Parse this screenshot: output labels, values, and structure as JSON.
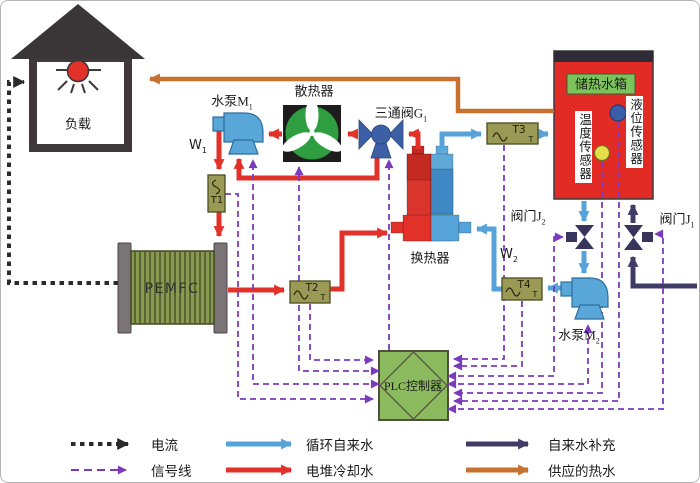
{
  "labels": {
    "load": "负载",
    "pump_m1": {
      "text": "水泵M",
      "sub": "1"
    },
    "radiator": "散热器",
    "valve_g1": {
      "text": "三通阀G",
      "sub": "1"
    },
    "w1": {
      "text": "W",
      "sub": "1"
    },
    "tank": "储热水箱",
    "temp_sensor": "温度传感器",
    "level_sensor": "液位传感器",
    "valve_j2": {
      "text": "阀门J",
      "sub": "2"
    },
    "valve_j1": {
      "text": "阀门J",
      "sub": "1"
    },
    "heat_exchanger": "换热器",
    "w2": {
      "text": "W",
      "sub": "2"
    },
    "pemfc": "PEMFC",
    "pump_m2": {
      "text": "水泵M",
      "sub": "2"
    },
    "plc": "PLC控制器",
    "t1": "T1",
    "t2": "T2",
    "t3": "T3",
    "t4": "T4",
    "t_sub": "T"
  },
  "legend": {
    "items": [
      {
        "label": "电流",
        "style": "dotted",
        "color": "#2b2b2b"
      },
      {
        "label": "信号线",
        "style": "dashed",
        "color": "#7a3bbf"
      },
      {
        "label": "循环自来水",
        "style": "solid",
        "color": "#55a3d8"
      },
      {
        "label": "电堆冷却水",
        "style": "solid",
        "color": "#e23128"
      },
      {
        "label": "自来水补充",
        "style": "solid",
        "color": "#3f3d66"
      },
      {
        "label": "供应的热水",
        "style": "solid",
        "color": "#c8702f"
      }
    ]
  },
  "colors": {
    "coolant_red": "#e23128",
    "tap_water_blue": "#55a3d8",
    "supply_navy": "#3f3d66",
    "hot_water_orange": "#c8702f",
    "signal_purple": "#7a3bbf",
    "current_black": "#2b2b2b",
    "tank_red": "#e32b26",
    "plc_green": "#8cba5e",
    "radiator_green": "#2f9e41",
    "pump_blue": "#58a7d8",
    "valve_blue": "#3c5fa5",
    "sensor_box_olive": "#9a9a55",
    "pemfc_olive": "#8b9a52",
    "tank_label_green": "#7cc35b",
    "temp_dot_yellow": "#e3e04a",
    "level_dot_blue": "#3a5fa8"
  }
}
